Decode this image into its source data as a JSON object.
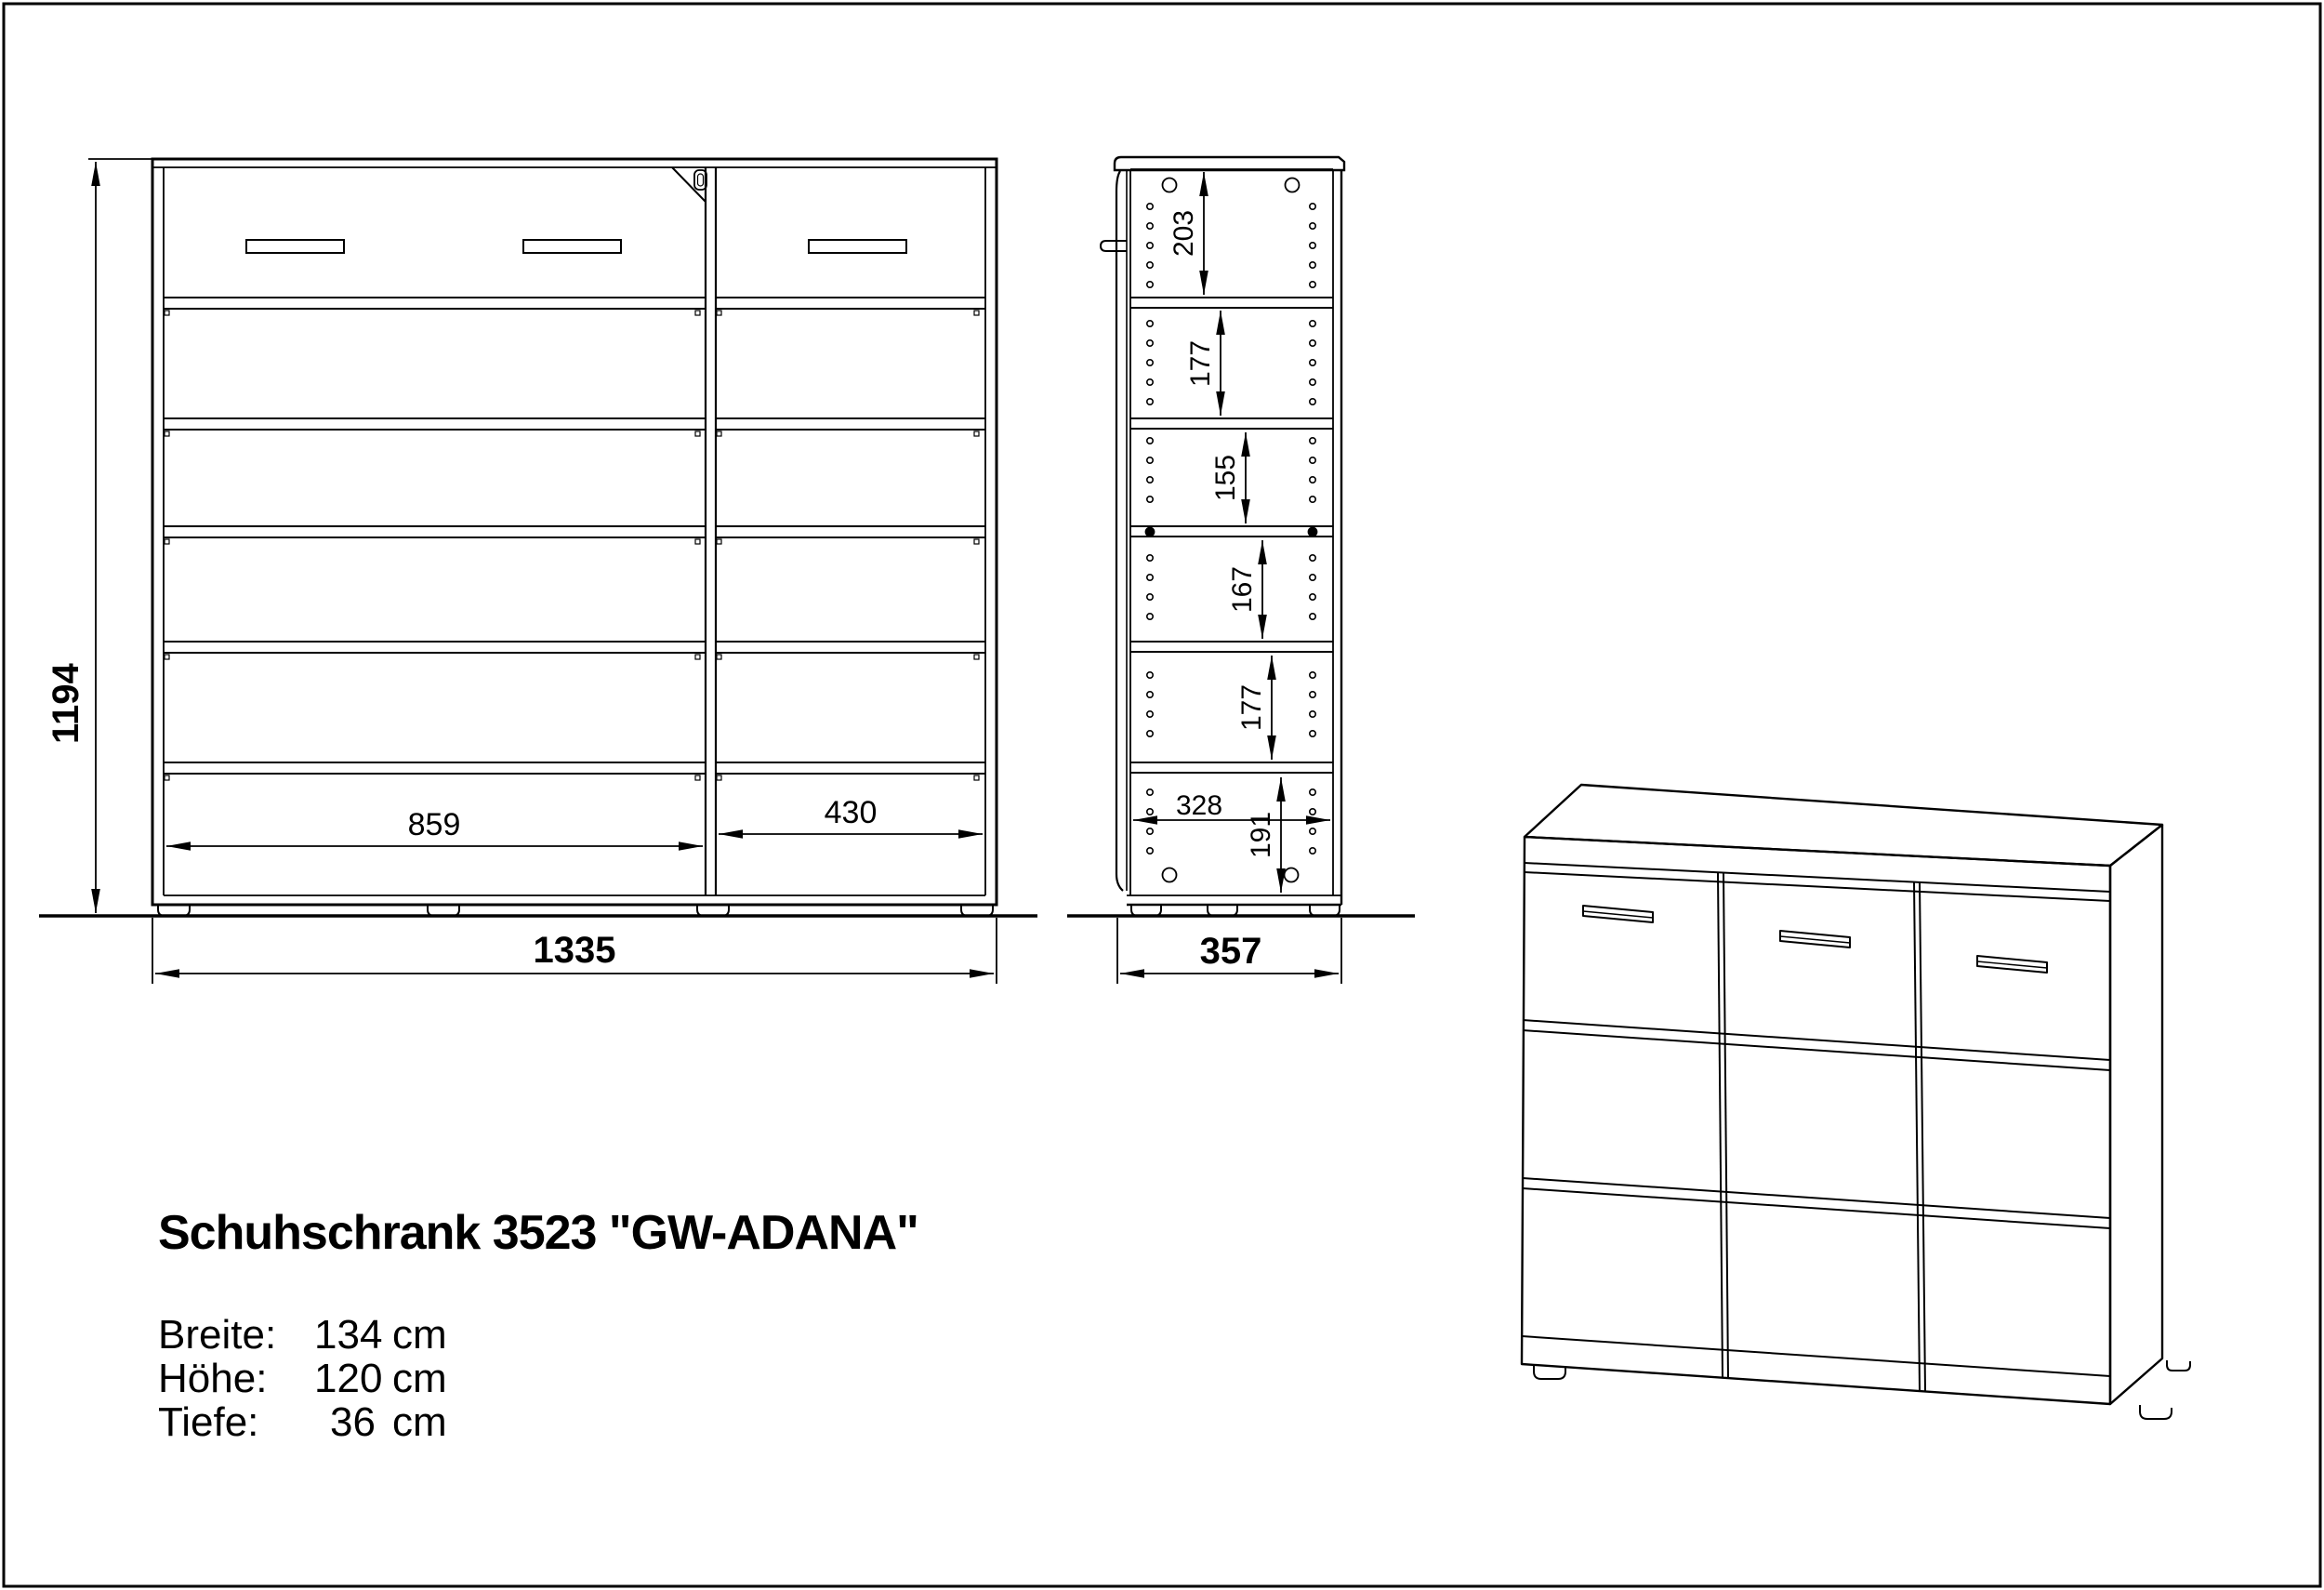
{
  "page": {
    "background": "#ffffff",
    "line_color": "#000000"
  },
  "title_block": {
    "title": "Schuhschrank 3523 \"GW-ADANA\"",
    "specs": [
      {
        "label": "Breite:",
        "value": "134",
        "unit": "cm"
      },
      {
        "label": "Höhe:",
        "value": "120",
        "unit": "cm"
      },
      {
        "label": "Tiefe:",
        "value": "36",
        "unit": "cm"
      }
    ]
  },
  "front_view": {
    "dim_height": "1194",
    "dim_left_compartment": "859",
    "dim_right_compartment": "430",
    "dim_total_width": "1335"
  },
  "side_view": {
    "dim_sections": [
      "203",
      "177",
      "155",
      "167",
      "177"
    ],
    "dim_depth_inner": "328",
    "dim_bottom_section": "191",
    "dim_total_depth": "357"
  }
}
